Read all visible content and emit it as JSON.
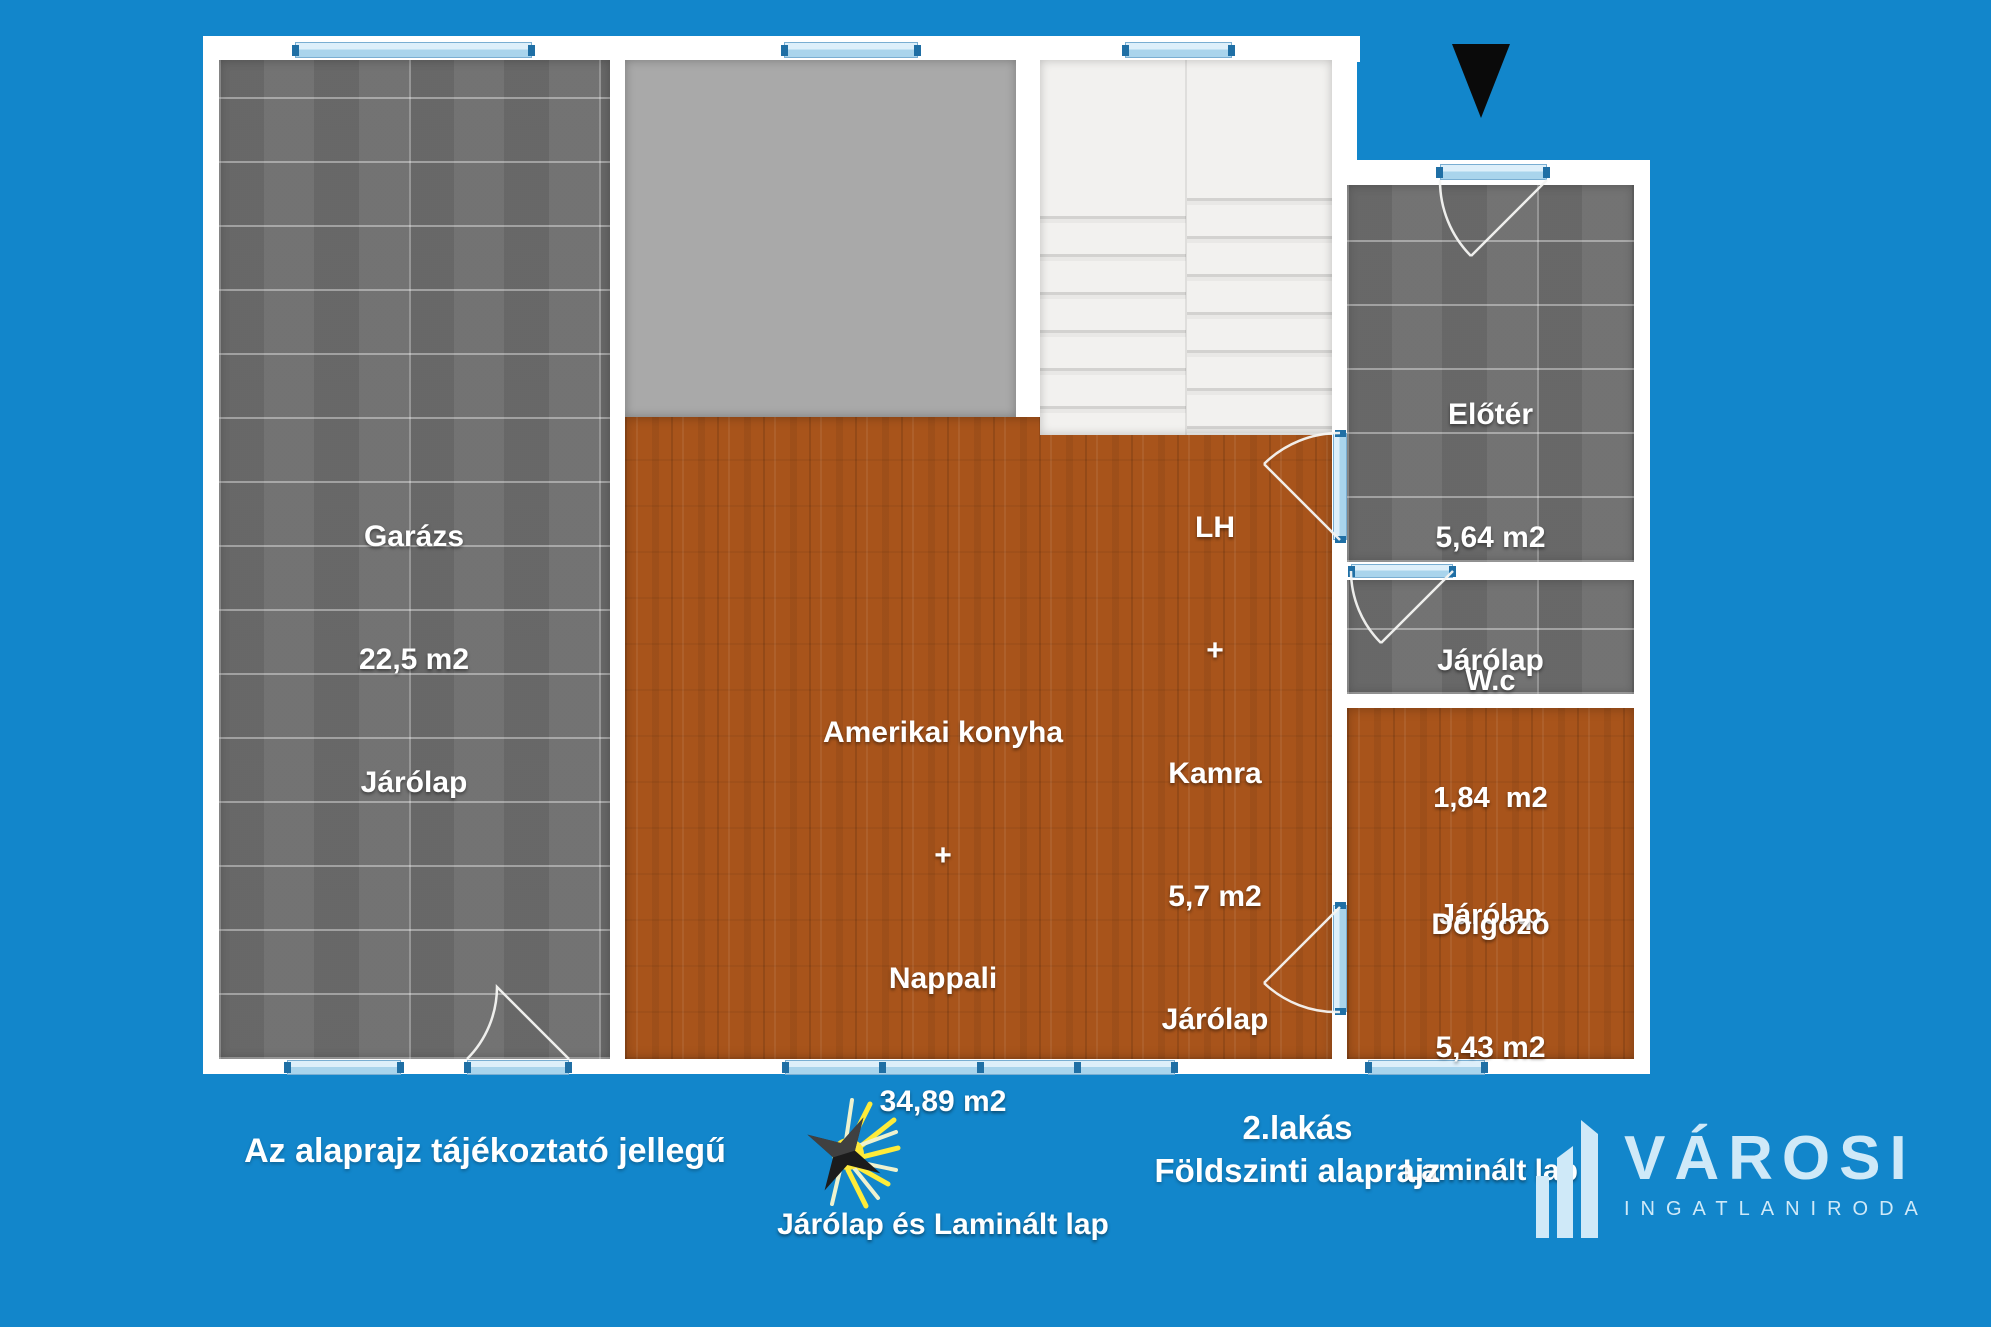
{
  "colors": {
    "background": "#1286cb",
    "wall": "#ffffff",
    "tile_floor": "#6d6d6d",
    "wood_floor": "#a8541b",
    "terrace_gray": "#a9a9a9",
    "window_blue": "#a9d4ec",
    "logo_blue": "#cfe9f8"
  },
  "icons": {
    "north_arrow": "north-arrow-triangle",
    "compass_star": "compass-starburst",
    "logo_buildings": "city-buildings"
  },
  "rooms": [
    {
      "name": "Garázs",
      "area": "22,5 m2",
      "floor": "Járólap"
    },
    {
      "name": "Amerikai konyha",
      "connector": "+",
      "name2": "Nappali",
      "area": "34,89 m2",
      "floor": "Járólap és Laminált lap"
    },
    {
      "name": "LH",
      "connector": "+",
      "name2": "Kamra",
      "area": "5,7 m2",
      "floor": "Járólap"
    },
    {
      "name": "Előtér",
      "area": "5,64 m2",
      "floor": "Járólap"
    },
    {
      "name": "W.c",
      "area": "1,84  m2",
      "floor": "Járólap"
    },
    {
      "name": "Dolgozó",
      "area": "5,43 m2",
      "floor": "Laminált lap"
    }
  ],
  "footer": {
    "disclaimer": "Az alaprajz tájékoztató jellegű",
    "unit_line1": "2.lakás",
    "unit_line2": "Földszinti alaprajz"
  },
  "logo": {
    "brand": "VÁROSI",
    "subtitle": "INGATLANIRODA"
  }
}
